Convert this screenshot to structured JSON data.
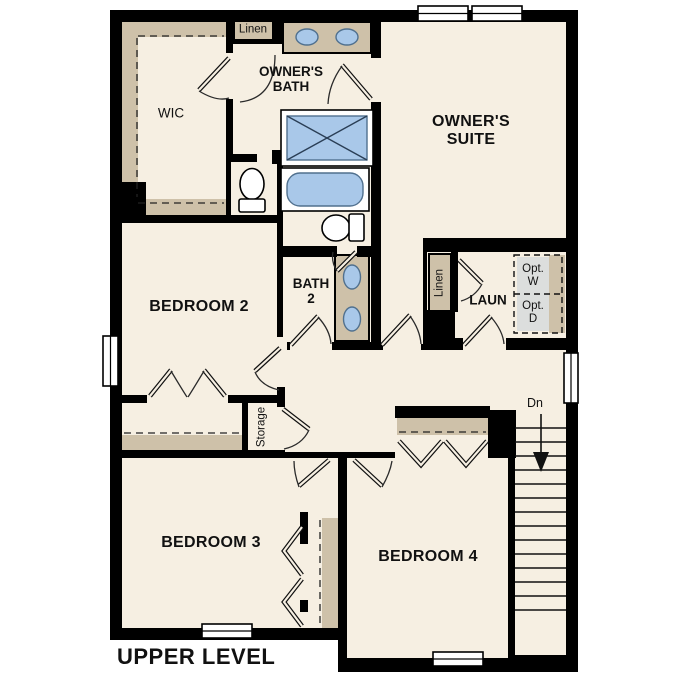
{
  "title": "UPPER LEVEL",
  "colors": {
    "floor": "#f6efe2",
    "wall": "#000000",
    "casework_tan": "#cec1a9",
    "fixture_blue": "#a9c8e9",
    "optional_gray": "#dcdedd"
  },
  "rooms": {
    "wic": {
      "label": "WIC"
    },
    "owners_bath": {
      "line1": "OWNER'S",
      "line2": "BATH"
    },
    "owners_suite": {
      "line1": "OWNER'S",
      "line2": "SUITE"
    },
    "bedroom2": {
      "label": "BEDROOM 2"
    },
    "bath2": {
      "line1": "BATH",
      "line2": "2"
    },
    "laundry": {
      "label": "LAUN"
    },
    "bedroom3": {
      "label": "BEDROOM 3"
    },
    "bedroom4": {
      "label": "BEDROOM 4"
    }
  },
  "closets": {
    "linen_top": {
      "label": "Linen"
    },
    "linen_laundry": {
      "label": "Linen"
    },
    "storage": {
      "label": "Storage"
    }
  },
  "appliances": {
    "washer": {
      "line1": "Opt.",
      "line2": "W"
    },
    "dryer": {
      "line1": "Opt.",
      "line2": "D"
    }
  },
  "stairs": {
    "label": "Dn"
  }
}
